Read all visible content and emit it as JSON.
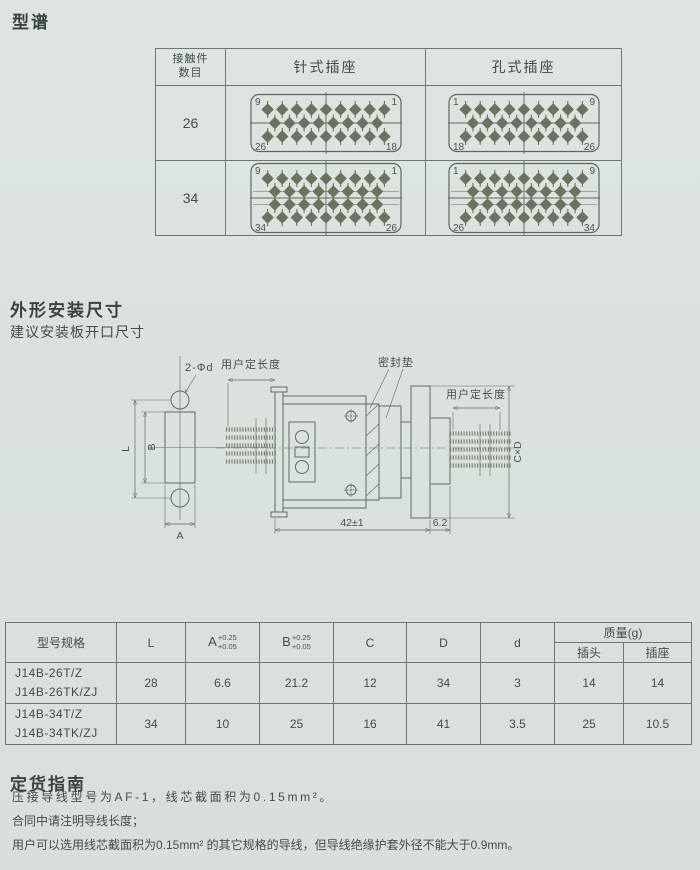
{
  "colors": {
    "pin_fill": "#6b7360",
    "diagram_line": "#5c665f",
    "drawing_line": "#5f6963",
    "text_dark": "#39423e",
    "page_bg": "#dce3df",
    "border": "#6d7772"
  },
  "spectrum": {
    "title": "型谱",
    "header": {
      "contacts_line1": "接触件",
      "contacts_line2": "数目",
      "pin_type": "针式插座",
      "hole_type": "孔式插座"
    },
    "rows": [
      {
        "count": "26",
        "pin": {
          "rows": [
            9,
            8,
            9
          ],
          "tl": "9",
          "tr": "1",
          "bl": "26",
          "br": "18"
        },
        "hole": {
          "rows": [
            9,
            8,
            9
          ],
          "tl": "1",
          "tr": "9",
          "bl": "18",
          "br": "26"
        }
      },
      {
        "count": "34",
        "pin": {
          "rows": [
            9,
            8,
            8,
            9
          ],
          "tl": "9",
          "tr": "1",
          "bl": "34",
          "br": "26"
        },
        "hole": {
          "rows": [
            9,
            8,
            8,
            9
          ],
          "tl": "1",
          "tr": "9",
          "bl": "26",
          "br": "34"
        }
      }
    ]
  },
  "outline": {
    "title": "外形安装尺寸",
    "subtitle": "建议安装板开口尺寸",
    "labels": {
      "holes": "2-Φd",
      "user_length_left": "用户定长度",
      "seal": "密封垫",
      "user_length_right": "用户定长度",
      "cxd": "C×D",
      "L": "L",
      "B": "B",
      "A": "A",
      "overall": "42±1",
      "flange": "6.2"
    }
  },
  "dims": {
    "header": {
      "model": "型号规格",
      "L": "L",
      "A": "A",
      "A_sup": "+0.25",
      "A_sub": "+0.05",
      "B": "B",
      "B_sup": "+0.25",
      "B_sub": "+0.05",
      "C": "C",
      "D": "D",
      "d": "d",
      "mass": "质量(g)",
      "plug": "插头",
      "socket": "插座"
    },
    "rows": [
      {
        "model_line1": "J14B-26T/Z",
        "model_line2": "J14B-26TK/ZJ",
        "L": "28",
        "A": "6.6",
        "B": "21.2",
        "C": "12",
        "D": "34",
        "d": "3",
        "plug_mass": "14",
        "socket_mass": "14"
      },
      {
        "model_line1": "J14B-34T/Z",
        "model_line2": "J14B-34TK/ZJ",
        "L": "34",
        "A": "10",
        "B": "25",
        "C": "16",
        "D": "41",
        "d": "3.5",
        "plug_mass": "25",
        "socket_mass": "10.5"
      }
    ]
  },
  "ordering": {
    "title": "定货指南",
    "lines": [
      "压接导线型号为AF-1，线芯截面积为0.15mm²。",
      "合同中请注明导线长度；",
      "用户可以选用线芯截面积为0.15mm² 的其它规格的导线，但导线绝缘护套外径不能大于0.9mm。"
    ]
  }
}
